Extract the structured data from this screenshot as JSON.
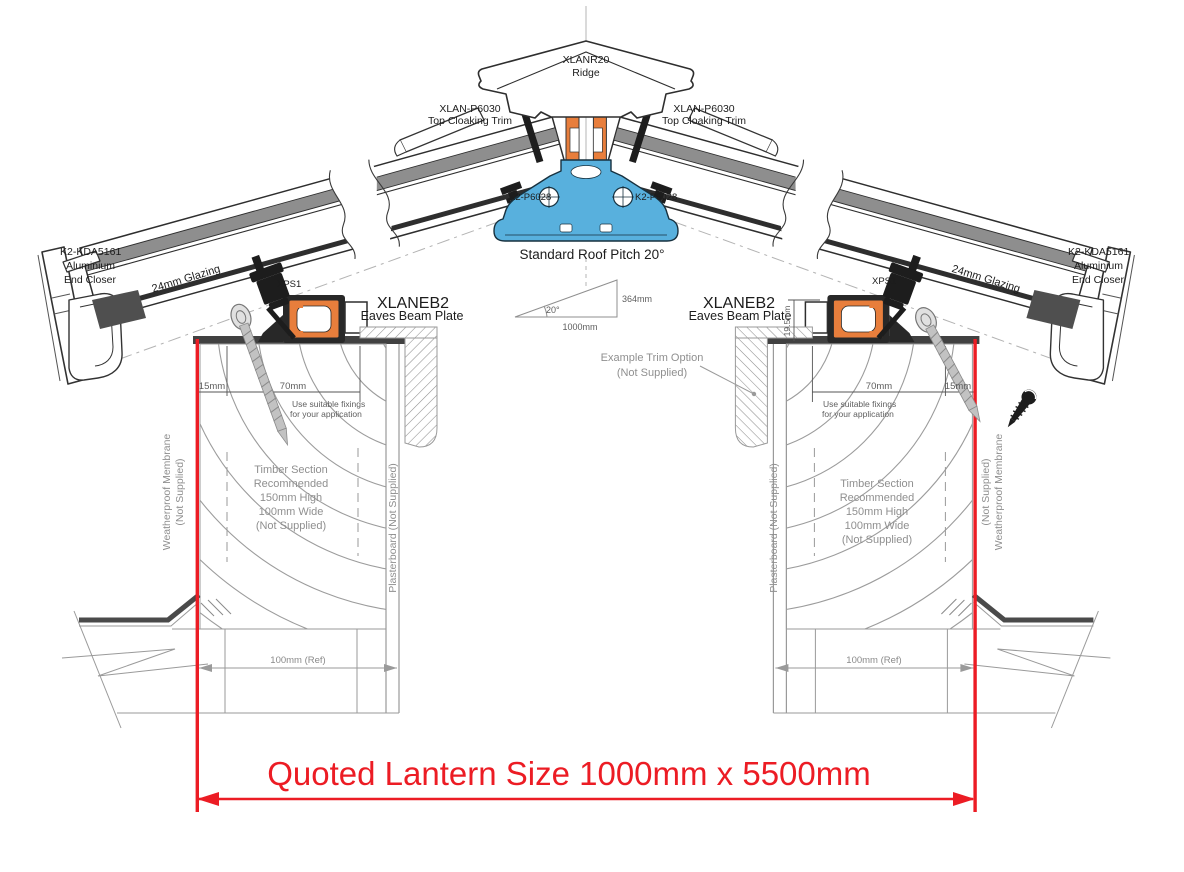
{
  "drawing": {
    "title": "Roof lantern cross-section installation detail",
    "colors": {
      "beam_orange": "#E87E3C",
      "ridge_blue": "#58B0DD",
      "dimension_red": "#EC1C24",
      "outline_dark": "#2E2E2E",
      "metal_gray": "#8E8E8E",
      "note_gray": "#8F8F8F"
    }
  },
  "ridge": {
    "part": "XLANR20",
    "name": "Ridge"
  },
  "cloaking_trim": {
    "part": "XLAN-P6030",
    "name": "Top Cloaking Trim"
  },
  "ridge_fixing": {
    "part": "K2-P6028"
  },
  "pitch": {
    "label": "Standard Roof Pitch 20°",
    "angle": "20°",
    "run": "1000mm",
    "rise": "364mm"
  },
  "glazing": {
    "label": "24mm Glazing"
  },
  "end_closer": {
    "part": "K2-KDA5161",
    "line2": "Aluminium",
    "line3": "End Closer"
  },
  "eaves_beam": {
    "part": "XLANEB2",
    "name": "Eaves Beam Plate",
    "height": "19.5mm"
  },
  "gasket": {
    "part": "XPS1"
  },
  "upstand": {
    "edge_offset": "15mm",
    "beam_seat": "70mm",
    "fixing_note_line1": "Use suitable fixings",
    "fixing_note_line2": "for your application",
    "wall_ref": "100mm (Ref)"
  },
  "timber": {
    "lines": [
      "Timber Section",
      "Recommended",
      "150mm High",
      "100mm Wide",
      "(Not Supplied)"
    ]
  },
  "membrane": {
    "line1": "Weatherproof Membrane",
    "line2": "(Not Supplied)"
  },
  "plasterboard": {
    "label": "Plasterboard (Not Supplied)"
  },
  "trim_option": {
    "line1": "Example  Trim Option",
    "line2": "(Not Supplied)"
  },
  "quote": {
    "label": "Quoted Lantern Size 1000mm x 5500mm"
  }
}
